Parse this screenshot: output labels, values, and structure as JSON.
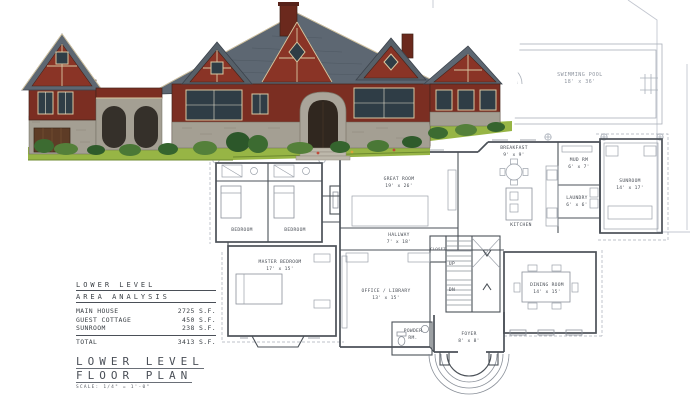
{
  "colors": {
    "wall_maroon": "#7b2e22",
    "roof_slate": "#5d6772",
    "stone_gray": "#a49f93",
    "trim_cream": "#d8c8a2",
    "grass_green": "#97b545",
    "plan_line": "#4b5158",
    "site_line": "#c3c7d0"
  },
  "area_analysis": {
    "title_line1": "LOWER LEVEL",
    "title_line2": "AREA ANALYSIS",
    "rows": [
      {
        "label": "MAIN HOUSE",
        "value": "2725 S.F."
      },
      {
        "label": "GUEST COTTAGE",
        "value": "450 S.F."
      },
      {
        "label": "SUNROOM",
        "value": "238 S.F."
      }
    ],
    "total_label": "TOTAL",
    "total_value": "3413 S.F."
  },
  "plan_title": {
    "line1": "LOWER LEVEL",
    "line2": "FLOOR PLAN",
    "scale": "SCALE: 1/4\" = 1'-0\""
  },
  "floor_plan": {
    "pool": {
      "name": "SWIMMING POOL",
      "dims": "18' x 36'"
    },
    "stairs": {
      "up": "UP",
      "dn": "DN"
    },
    "rooms": [
      {
        "name": "GREAT ROOM",
        "dims": "19' x 26'"
      },
      {
        "name": "HALLWAY",
        "dims": "7' x 18'"
      },
      {
        "name": "BREAKFAST",
        "dims": "9' x 9'"
      },
      {
        "name": "KITCHEN",
        "dims": ""
      },
      {
        "name": "MUD RM",
        "dims": "6' x 7'"
      },
      {
        "name": "LAUNDRY",
        "dims": "6' x 6'"
      },
      {
        "name": "SUNROOM",
        "dims": "14' x 17'"
      },
      {
        "name": "DINING ROOM",
        "dims": "14' x 15'"
      },
      {
        "name": "OFFICE / LIBRARY",
        "dims": "13' x 15'"
      },
      {
        "name": "MASTER BEDROOM",
        "dims": "17' x 15'"
      },
      {
        "name": "BEDROOM",
        "dims": ""
      },
      {
        "name": "BEDROOM",
        "dims": ""
      },
      {
        "name": "CLOSET",
        "dims": ""
      },
      {
        "name": "FOYER",
        "dims": "8' x 8'"
      },
      {
        "name": "POWDER",
        "dims": "RM."
      }
    ]
  }
}
